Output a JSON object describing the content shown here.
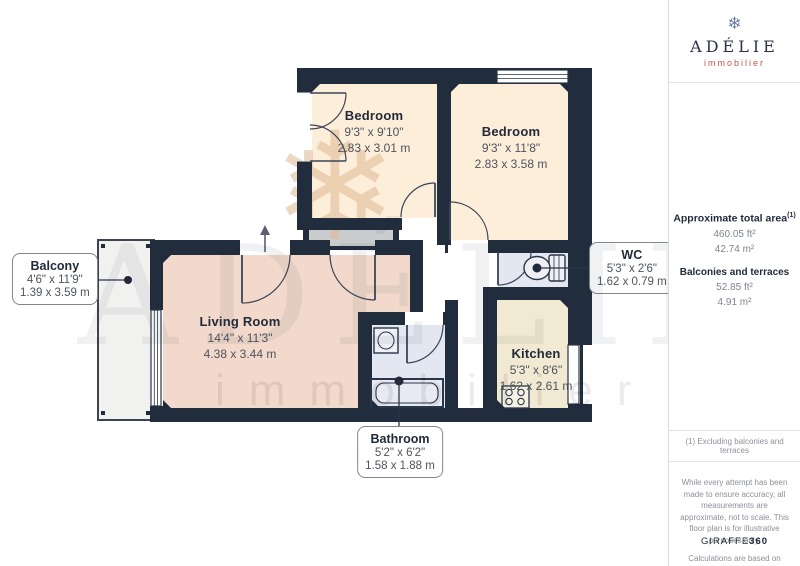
{
  "logo": {
    "name": "ADÉLIE",
    "tagline": "immobilier",
    "snowflake": "❄"
  },
  "watermark": {
    "title": "ADÉLIE",
    "tagline": "immobilier",
    "snowflake": "❄"
  },
  "rooms": {
    "bedroom1": {
      "name": "Bedroom",
      "imperial": "9'3\" x 9'10\"",
      "metric": "2.83 x 3.01 m"
    },
    "bedroom2": {
      "name": "Bedroom",
      "imperial": "9'3\" x 11'8\"",
      "metric": "2.83 x 3.58 m"
    },
    "living": {
      "name": "Living Room",
      "imperial": "14'4\" x 11'3\"",
      "metric": "4.38 x 3.44 m"
    },
    "kitchen": {
      "name": "Kitchen",
      "imperial": "5'3\" x 8'6\"",
      "metric": "1.62 x 2.61 m"
    },
    "wc": {
      "name": "WC",
      "imperial": "5'3\" x 2'6\"",
      "metric": "1.62 x 0.79 m"
    },
    "bathroom": {
      "name": "Bathroom",
      "imperial": "5'2\" x 6'2\"",
      "metric": "1.58 x 1.88 m"
    },
    "balcony": {
      "name": "Balcony",
      "imperial": "4'6\" x 11'9\"",
      "metric": "1.39 x 3.59 m"
    }
  },
  "sidebar": {
    "total_area_label": "Approximate total area",
    "total_area_sup": "(1)",
    "total_area_ft": "460.05 ft²",
    "total_area_m": "42.74 m²",
    "balconies_label": "Balconies and terraces",
    "balconies_ft": "52.85 ft²",
    "balconies_m": "4.91 m²",
    "footnote": "(1) Excluding balconies and terraces",
    "disclaimer": "While every attempt has been made to ensure accuracy, all measurements are approximate, not to scale. This floor plan is for illustrative purposes only.",
    "standard": "Calculations are based on RICS IPMS 3C standard.",
    "brand": "GIRAFFE",
    "brand_suffix": "360"
  },
  "colors": {
    "wall": "#212c3d",
    "bedroom_fill": "#fdeeda",
    "living_fill": "#f2d9cb",
    "kitchen_fill": "#f1e9d1",
    "wet_room_fill": "#e2e7f2",
    "balcony_fill": "#f1f1ef",
    "brand_accent": "#c4574e"
  }
}
